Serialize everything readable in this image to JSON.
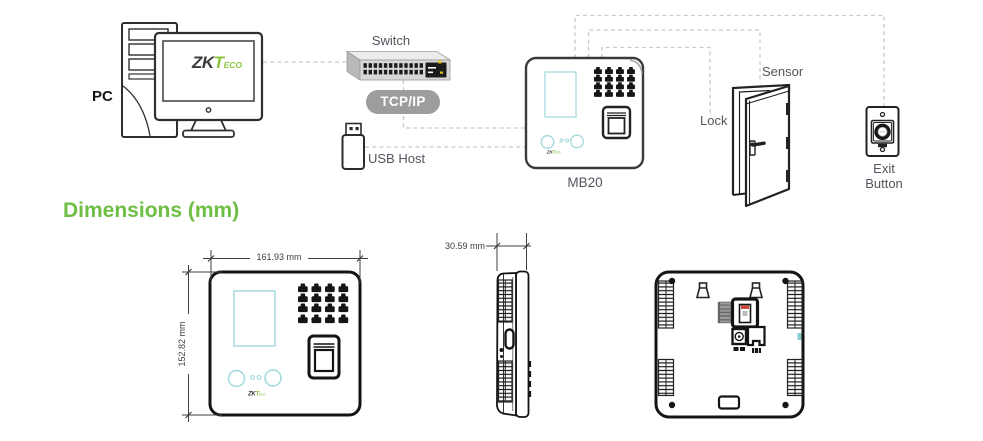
{
  "topology": {
    "pc_label": "PC",
    "switch_label": "Switch",
    "protocol_badge": "TCP/IP",
    "usb_host_label": "USB Host",
    "device_label": "MB20",
    "lock_label": "Lock",
    "sensor_label": "Sensor",
    "exit_button_label_line1": "Exit",
    "exit_button_label_line2": "Button"
  },
  "brand": {
    "zk": "ZK",
    "t": "T",
    "eco": "ECO"
  },
  "dimensions_section": {
    "title": "Dimensions (mm)",
    "front_width": "161.93 mm",
    "front_height": "152.82 mm",
    "side_depth": "30.59 mm"
  },
  "colors": {
    "title_green": "#6ebe44",
    "logo_green": "#8bc53f",
    "screen_teal": "#9fd9db",
    "label_gray": "#54545e",
    "badge_gray": "#9d9d9d",
    "dash_gray": "#c9c9c9",
    "line_black": "#141414",
    "usb_red": "#cc4433",
    "switch_yellow": "#e8c11c"
  }
}
